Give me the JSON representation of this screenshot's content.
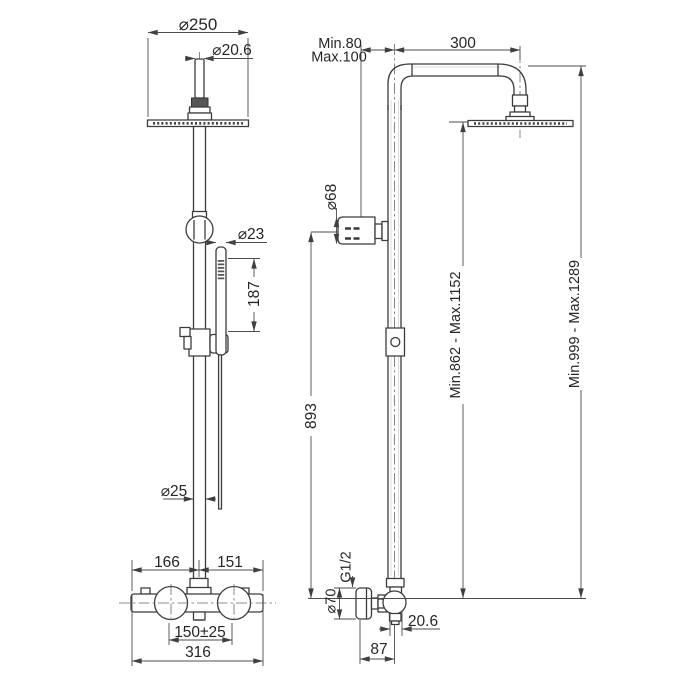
{
  "drawing_title": "Shower column technical drawing",
  "front_view": {
    "dims": {
      "head_diameter": "⌀250",
      "pipe_diameter_top": "⌀20.6",
      "handshower_diameter": "⌀23",
      "handshower_length": "187",
      "column_diameter": "⌀25",
      "valve_left_span": "166",
      "valve_right_span": "151",
      "inlet_centers": "150±25",
      "valve_total_width": "316"
    }
  },
  "side_view": {
    "dims": {
      "wall_offset_min": "Min.80",
      "wall_offset_max": "Max.100",
      "arm_reach": "300",
      "diverter_knob_diameter": "⌀68",
      "riser_height": "893",
      "head_height_range": "Min.862 - Max.1152",
      "total_height_range": "Min.999 - Max.1289",
      "inlet_thread": "G1/2",
      "valve_body_diameter": "⌀70",
      "outlet_width": "20.6",
      "wall_to_center": "87"
    }
  }
}
